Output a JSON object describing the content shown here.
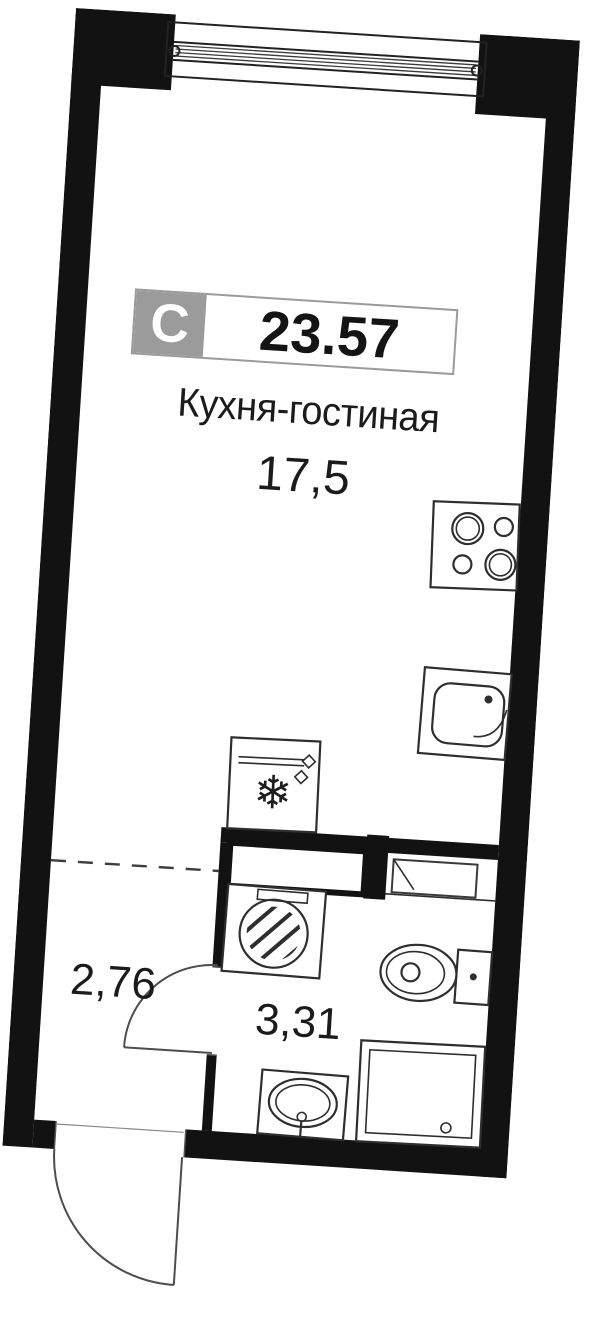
{
  "unit": {
    "type_badge": "С",
    "total_area": "23.57",
    "kitchen_living": {
      "name": "Кухня-гостиная",
      "area": "17,5"
    },
    "hallway": {
      "area": "2,76"
    },
    "bathroom": {
      "area": "3,31"
    }
  },
  "icons": {
    "fridge_snowflake": "❄"
  },
  "colors": {
    "wall": "#121212",
    "fixture_line": "#2e2e2e",
    "badge_gray": "#9b9b9b",
    "text": "#1b1b1b"
  }
}
